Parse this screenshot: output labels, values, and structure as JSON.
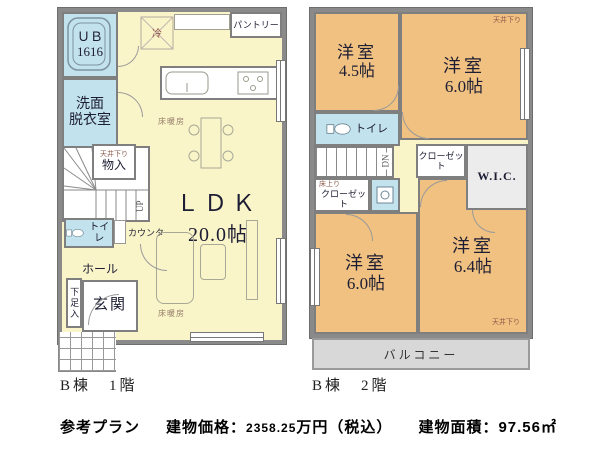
{
  "colors": {
    "room_yellow": "#faf5c9",
    "room_blue": "#c2e2ee",
    "room_orange": "#f0c180",
    "wall_gray": "#8a8a8a",
    "balcony_gray": "#d8d8d8",
    "annotation_brown": "#8b5a4b",
    "text_dark": "#1d1d33"
  },
  "floor1": {
    "caption": "B棟　1階",
    "ub": {
      "line1": "ＵＢ",
      "line2": "1616"
    },
    "senmen": {
      "line1": "洗面",
      "line2": "脱衣室"
    },
    "ceiling_drop": "天井下り",
    "storage": "物入",
    "up": "UP",
    "toilet": "トイレ",
    "counter": "カウンター",
    "hall": "ホール",
    "shoe_box": "下足入",
    "entrance": "玄関",
    "ldk": {
      "name": "ＬＤＫ",
      "size": "20.0帖"
    },
    "pantry": "パントリー",
    "fridge": "冷",
    "floor_heating": "床暖房"
  },
  "floor2": {
    "caption": "B棟　2階",
    "room_tl": {
      "name": "洋室",
      "size": "4.5帖"
    },
    "room_tr": {
      "name": "洋室",
      "size": "6.0帖"
    },
    "room_bl": {
      "name": "洋室",
      "size": "6.0帖"
    },
    "room_br": {
      "name": "洋室",
      "size": "6.4帖"
    },
    "toilet": "トイレ",
    "dn": "DN",
    "step_up_note": "床上り",
    "closet_left": "クローゼット",
    "closet_center": "クローゼット",
    "wic": "W.I.C.",
    "ceiling_drop_tr": "天井下り",
    "ceiling_drop_br": "天井下り",
    "balcony": "バルコニー"
  },
  "footer": {
    "plan": "参考プラン",
    "price_label": "建物価格：",
    "price_value": "2358.25",
    "price_suffix": "万円（税込）",
    "area_label": "建物面積：",
    "area_value": "97.56㎡"
  }
}
